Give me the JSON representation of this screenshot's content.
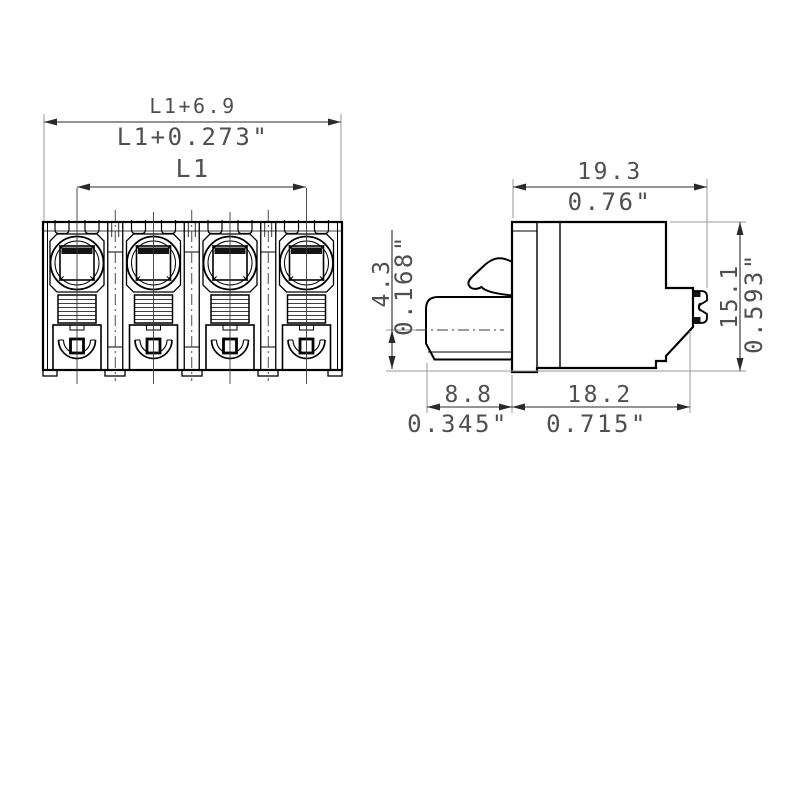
{
  "title": "Terminal block connector dimensional drawing",
  "colors": {
    "outline": "#000000",
    "dimension": "#2a2a2a",
    "extension": "#9a9a9a",
    "text": "#4f4f4f",
    "paper": "#ffffff"
  },
  "views": {
    "front": {
      "label": "front-view",
      "pole_count": 4
    },
    "side": {
      "label": "side-view"
    }
  },
  "dims": {
    "front": {
      "overall_mm": "L1+6.9",
      "overall_in": "L1+0.273\"",
      "pitch": "L1"
    },
    "side": {
      "width_mm": "19.3",
      "width_in": "0.76\"",
      "axis_mm": "4.3",
      "axis_in": "0.168\"",
      "height_mm": "15.1",
      "height_in": "0.593\"",
      "plug_mm": "8.8",
      "plug_in": "0.345\"",
      "depth_mm": "18.2",
      "depth_in": "0.715\""
    }
  }
}
